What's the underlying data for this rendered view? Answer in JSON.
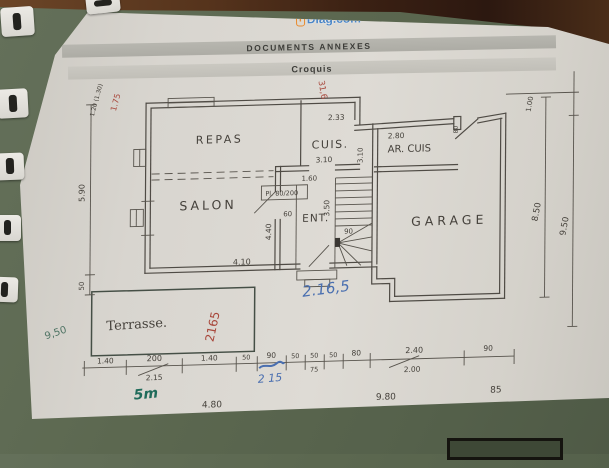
{
  "header": {
    "brand_icon": "i",
    "brand": "Diag.com",
    "banner1": "DOCUMENTS ANNEXES",
    "banner2": "Croquis"
  },
  "plan": {
    "rooms": {
      "repas": "REPAS",
      "cuis": "CUIS.",
      "ar_cuis": "AR. CUIS",
      "salon": "SALON",
      "ent": "ENT.",
      "garage": "GARAGE",
      "terrasse": "Terrasse."
    },
    "labels": {
      "closet": "Pl. 80/200",
      "closet_depth": "60"
    },
    "dims": {
      "top_left_window": "1.20 (1.30)",
      "left_height": "5.90",
      "left_bottom": "50",
      "kitchen_width": "2.33",
      "kitchen_step": "3.10",
      "arcuis_width": "2.80",
      "garage_door": "80",
      "hall_width": "3.10",
      "hall_door": "1.60",
      "stair_width": "90",
      "ent_depth": "3.50",
      "salon_depth": "4.40",
      "salon_width": "4.10",
      "right_top": "1.00",
      "right_inner": "8.50",
      "right_outer": "9.50",
      "bottom_ticks": [
        "1.40",
        "200",
        "1.40",
        "50",
        "90",
        "50",
        "50",
        "50",
        "80",
        "2.40",
        "90"
      ],
      "bottom_sub": {
        "s200": "2.15",
        "s75": "75",
        "s240": "2.00"
      },
      "bottom_edge": [
        "4.80",
        "9.80",
        "85"
      ]
    },
    "annotations": {
      "blue_area": "2.16,5",
      "blue_bottom": "2 15",
      "red_terrace": "2165",
      "red_top_left": "1.75",
      "red_top": "31,6",
      "green_left": "9,50",
      "green_scale": "5m"
    }
  },
  "colors": {
    "blue_pen": "#4a6fb0",
    "red_pen": "#a8473b",
    "green_pen": "#1f6b5a",
    "pencil": "#45413b",
    "accent_orange": "#e98a2d",
    "accent_blue": "#4c86c6"
  }
}
